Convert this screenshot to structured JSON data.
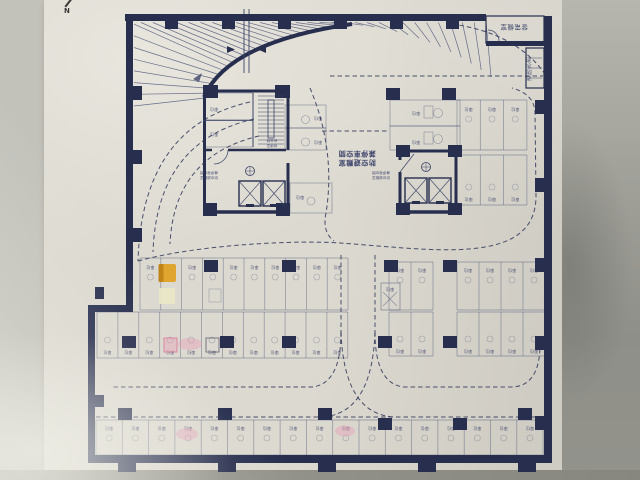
{
  "photo": {
    "north_label": "N"
  },
  "plan": {
    "stall_label": "車位",
    "center_annotation": {
      "line1": "防空避難室",
      "line2": "兼停車空間"
    },
    "rooms": {
      "generator": "發電機室",
      "water_tank": "消防水池"
    },
    "notes": {
      "stair_line1": "排煙室",
      "stair_line2": "安全梯",
      "evac_line1": "防空避難室",
      "evac_line2": "兼停車空間"
    },
    "colors": {
      "ink": "#272e4e",
      "ink_mid": "#3c4468",
      "ink_light": "#4a5276",
      "stall_line": "rgba(62,72,108,0.5)",
      "label_ink": "#2c3360",
      "highlight_orange": "#e0a52f",
      "highlight_orange_dark": "#bf8418",
      "highlight_pale": "#e9e6c6",
      "highlight_pink": "#d9849f",
      "pink_fill": "rgba(231,160,185,0.45)",
      "pencil": "rgba(95,95,115,0.8)"
    }
  }
}
